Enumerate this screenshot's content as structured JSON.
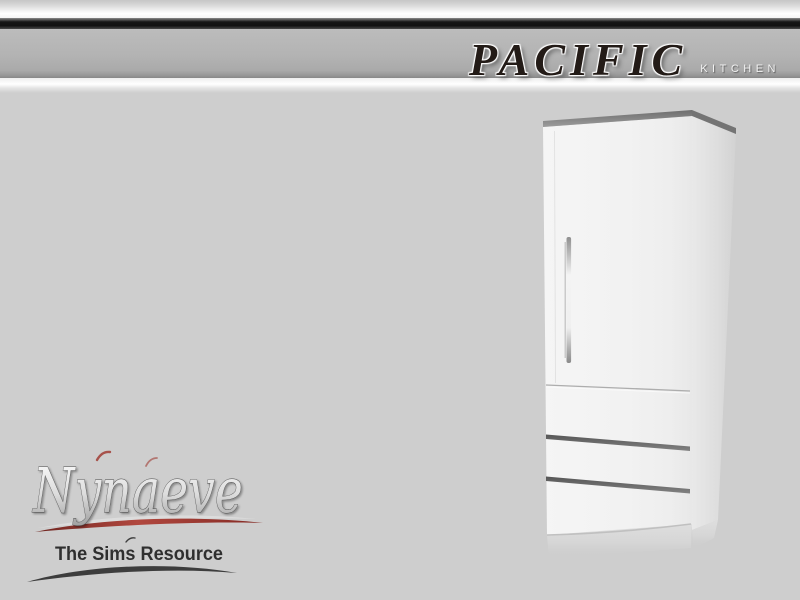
{
  "header": {
    "title": "PACIFIC",
    "subtitle": "KITCHEN"
  },
  "logo": {
    "name": "Nynaeve",
    "tagline": "The Sims Resource"
  },
  "colors": {
    "page-bg": "#cecece",
    "header-gray": "#b3b3b3",
    "header-black": "#171717",
    "title-color": "#231b17",
    "subtitle-color": "#f2f2f2",
    "tagline-color": "#2f2f2f",
    "accent-red": "#a03c34",
    "swoosh-dark": "#3d3d3d",
    "fridge-white": "#f2f2f2",
    "fridge-top-gray": "#8a8a8a",
    "drawer-bar-gray": "#6b6b6b"
  }
}
